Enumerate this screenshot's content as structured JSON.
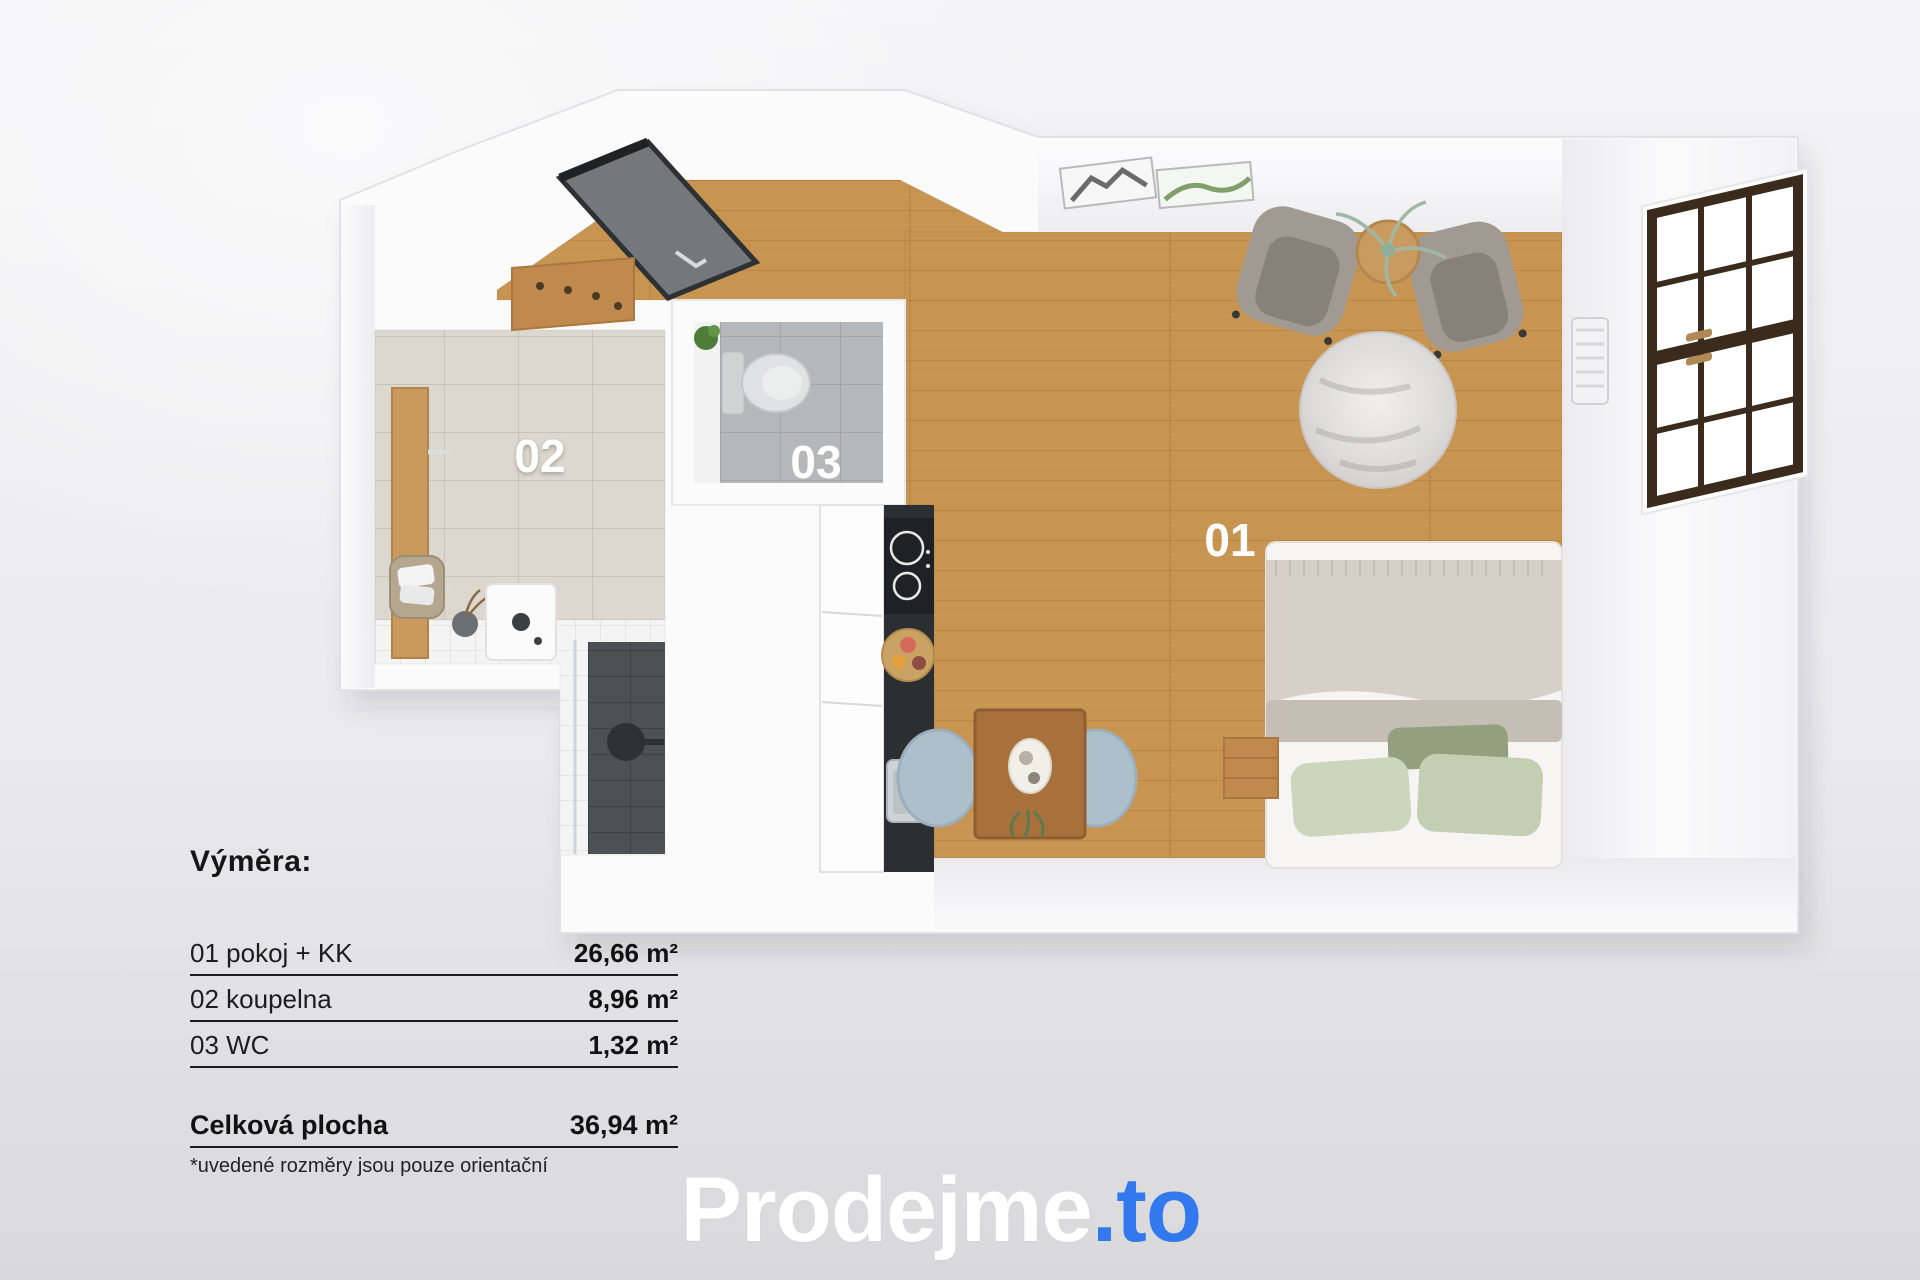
{
  "plan": {
    "description": "3D top-down floor plan of a studio apartment",
    "room_labels": {
      "r01": "01",
      "r02": "02",
      "r03": "03"
    }
  },
  "legend": {
    "heading": "Výměra:",
    "rows": [
      {
        "label": "01 pokoj + KK",
        "value": "26,66 m²"
      },
      {
        "label": "02 koupelna",
        "value": "8,96 m²"
      },
      {
        "label": "03 WC",
        "value": "1,32 m²"
      }
    ],
    "total_label": "Celková plocha",
    "total_value": "36,94 m²",
    "note": "*uvedené rozměry jsou pouze orientační"
  },
  "logo": {
    "primary": "Prodejme",
    "accent": ".to",
    "primary_color": "#ffffff",
    "accent_color": "#3279ef"
  }
}
